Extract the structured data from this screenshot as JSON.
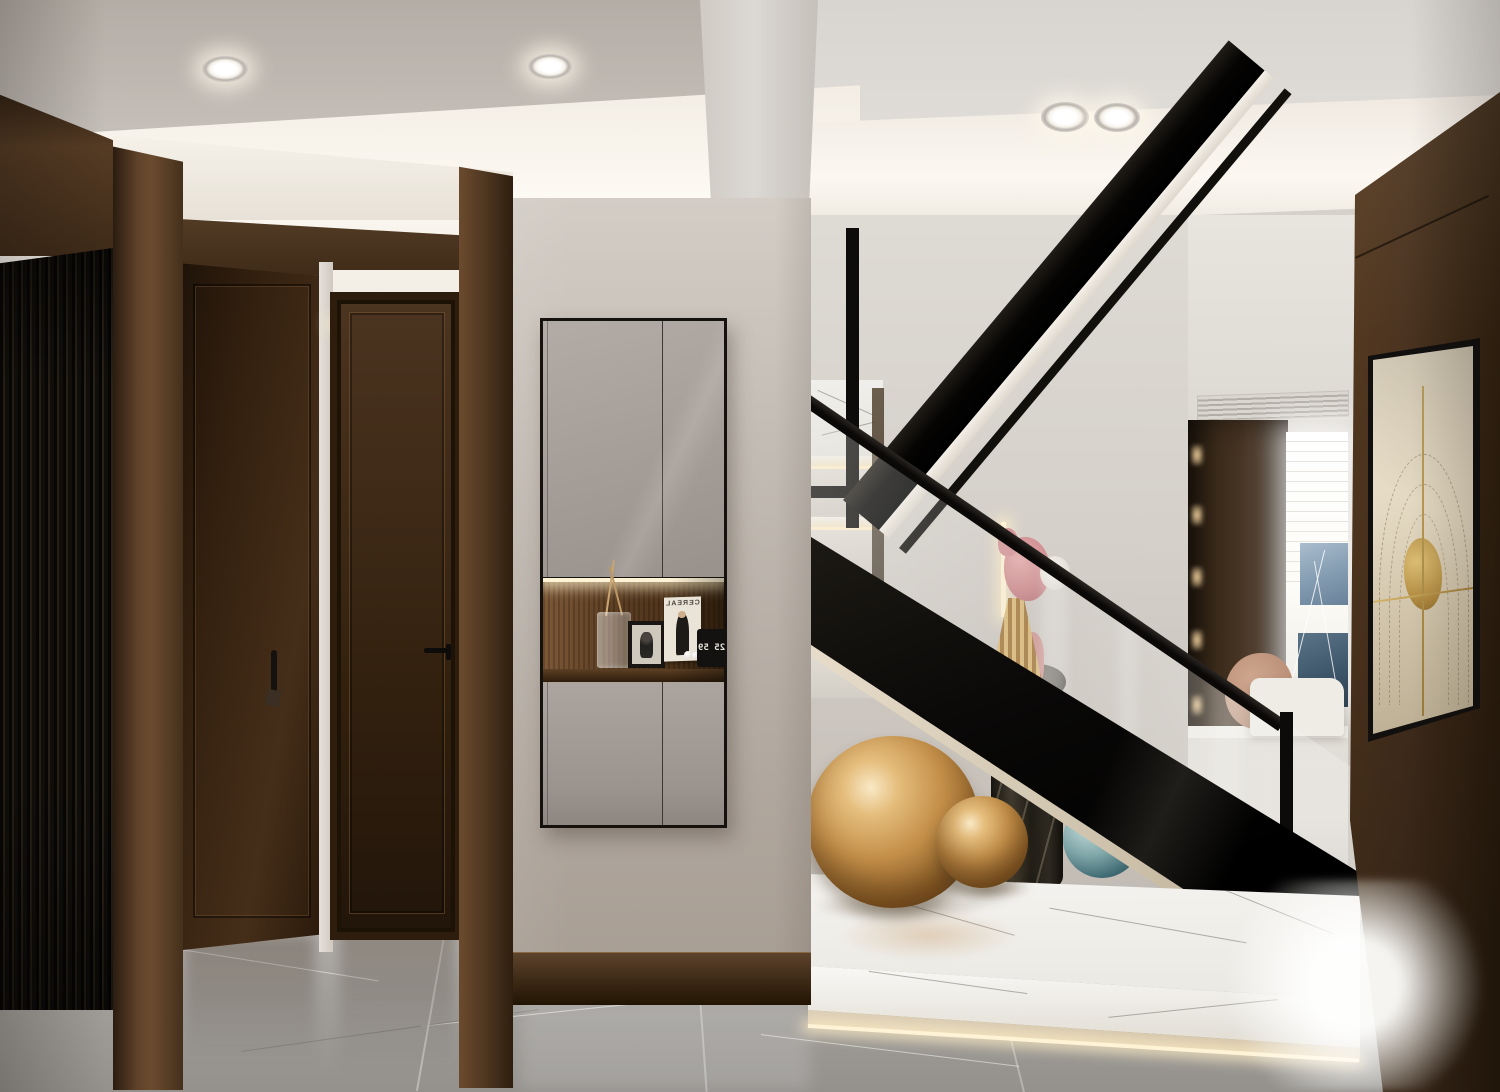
{
  "meta": {
    "title": "Modern entry hall with switchback black-steel staircase",
    "kind": "interior 3D render photograph",
    "width_px": 1500,
    "height_px": 1092
  },
  "palette": {
    "ceiling_gray": "#c2bbb4",
    "cove_light": "#fdfaf3",
    "wall_white": "#dedad4",
    "wall_cream": "#b3aaa1",
    "wood_dark": "#33210f",
    "wood_mid": "#5a3d28",
    "slat_black": "#12100c",
    "cabinet_taupe": "#a79f99",
    "stair_black": "#0c0a09",
    "stringer_trim_cream": "#cbbfa8",
    "marble_platform_white": "#f2efe9",
    "floor_marble_gray": "#a09d99",
    "gold_sphere": "#c08b45",
    "teal_glass": "#3f6a72",
    "sculpture_pink": "#cf8d90",
    "art_beige": "#e4d9c2",
    "art_gold": "#c3a65f"
  },
  "niche": {
    "magazine_title": "CEREAL",
    "magazine_title_is_mirrored": true,
    "clock_digits": "25 59",
    "clock_digits_are_mirrored": true
  },
  "objects": [
    "black-slatted-wall-panel",
    "walnut-door-left",
    "walnut-door-center",
    "wood-pilasters",
    "cove-lit-ceiling",
    "recessed-downlights-x4",
    "wall-hung-taupe-cabinet-with-lit-niche",
    "glass-vase-with-dried-stems",
    "framed-photo",
    "cereal-magazine",
    "flip-clock",
    "black-steel-switchback-staircase",
    "glass-balustrade-with-black-handrail",
    "white-marble-steps-with-led",
    "pink-and-gold-figurine",
    "black-marble-cylinder-plinth",
    "large-gold-sphere",
    "small-gold-sphere",
    "teal-glass-sphere",
    "white-marble-podium",
    "background-living-room-window",
    "dark-wood-display-shelving",
    "ac-linear-vent",
    "walnut-feature-wall-right",
    "framed-gold-line-artwork",
    "gray-marble-floor"
  ]
}
